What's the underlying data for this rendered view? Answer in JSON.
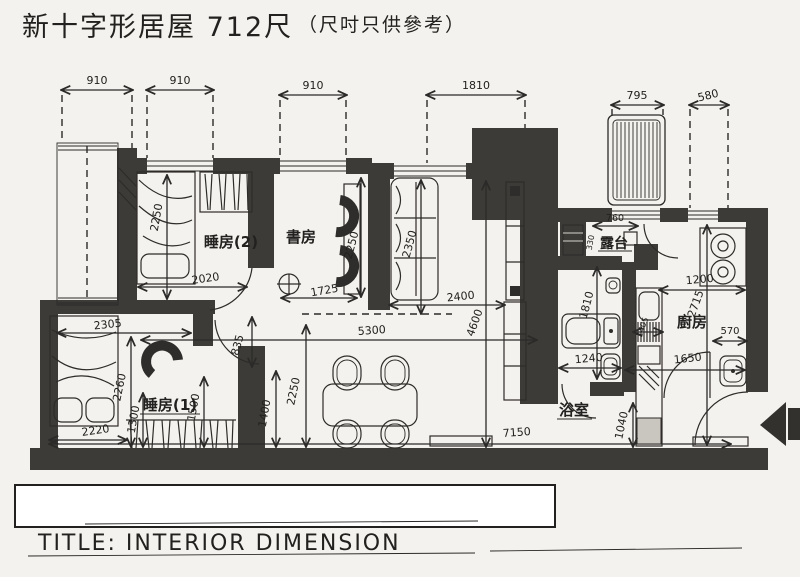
{
  "header": {
    "title": "新十字形居屋 712尺",
    "subtitle": "（尺吋只供參考）"
  },
  "title_block": {
    "label": "TITLE: INTERIOR DIMENSION"
  },
  "rooms": {
    "bedroom2": "睡房(2)",
    "study": "書房",
    "bedroom1": "睡房(1)",
    "balcony": "露台",
    "kitchen": "廚房",
    "bathroom": "浴室"
  },
  "dims": {
    "top_910_a": "910",
    "top_910_b": "910",
    "top_910_c": "910",
    "top_1810": "1810",
    "top_795": "795",
    "top_580": "580",
    "bed2_width": "2020",
    "bed2_depth": "2250",
    "study_width": "1725",
    "study_depth": "2250",
    "sofa_length": "2350",
    "living_width": "2400",
    "living_depth": "4600",
    "hall_width": "5300",
    "total_width": "7150",
    "bed1_top_width": "2305",
    "bed1_bottom_width": "2220",
    "bed1_depth": "2260",
    "bed1_inner": "1300",
    "bed1_door": "1500",
    "hall_opening": "835",
    "hall_left_depth": "2250",
    "hall_left_inner": "1400",
    "bath_width": "1240",
    "bath_depth": "1810",
    "kitchen_width": "1200",
    "kitchen_depth": "2715",
    "kitchen_sink": "570",
    "kitchen_bottom": "1650",
    "kitchen_counter": "1405",
    "balcony_width": "760",
    "balcony_depth": "330",
    "entry_depth": "1040"
  },
  "colors": {
    "paper": "#f4f2ee",
    "wall": "#3d3b37",
    "ink": "#2b2a28"
  }
}
